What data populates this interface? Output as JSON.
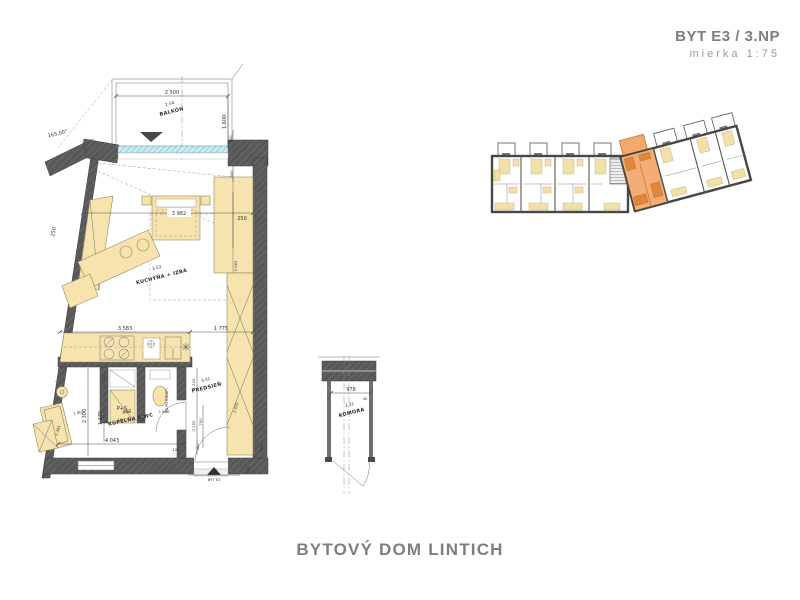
{
  "header": {
    "title": "BYT E3 / 3.NP",
    "scale": "mierka 1:75"
  },
  "footer": {
    "title": "BYTOVÝ DOM LINTICH"
  },
  "colors": {
    "wall": "#565656",
    "furniture": "#f6e3ae",
    "glazing": "#bfe0ea",
    "highlight_unit": "#f0a66a",
    "title_text": "#7d7d7d",
    "drawing_line": "#4a4a4a"
  },
  "main_plan": {
    "rooms": [
      {
        "number": "2.54",
        "name": "BALKÓN"
      },
      {
        "number": "3.53",
        "name": "KUCHYŇA + IZBA"
      },
      {
        "number": "3.52",
        "name": "KÚPEĽŇA S WC"
      },
      {
        "number": "3.51",
        "name": "PREDSIEŇ"
      }
    ],
    "labels": {
      "entrance": "BYT E3",
      "washer": "P+S",
      "wc_note": "(O.PO STROP)",
      "angle": "165.00°"
    },
    "dims": {
      "balcony_width": "2 500",
      "balcony_depth": "1 600",
      "wall_thickness": "250",
      "room_length": "3 982",
      "wardrobe_depth": "250",
      "wardrobe_length": "3 063",
      "kitchen_run": "3 583",
      "hall_top": "1 775",
      "bath_length": "4 043",
      "bath_width": "2 300",
      "bath_inner": "1 175",
      "basin_offset": "1 801",
      "tub_length": "2 381",
      "washer_top": "325",
      "washer_niche": "650",
      "washer_sub": "100",
      "door_jamb": "125",
      "wc_niche": "1 860",
      "hall_len": "1 225",
      "hall_wall": "2 150",
      "door_width": "700",
      "d550": "550",
      "d590": "590",
      "closet_height": "2 425",
      "bottom_right": "250",
      "pier_top": "200",
      "pier_bottom": "800",
      "floor_edge": "125"
    }
  },
  "storage_plan": {
    "room": {
      "number": "1.21",
      "name": "KOMORA"
    },
    "dims": {
      "width": "978",
      "jamb_right": "40",
      "jamb_left": "7"
    }
  }
}
